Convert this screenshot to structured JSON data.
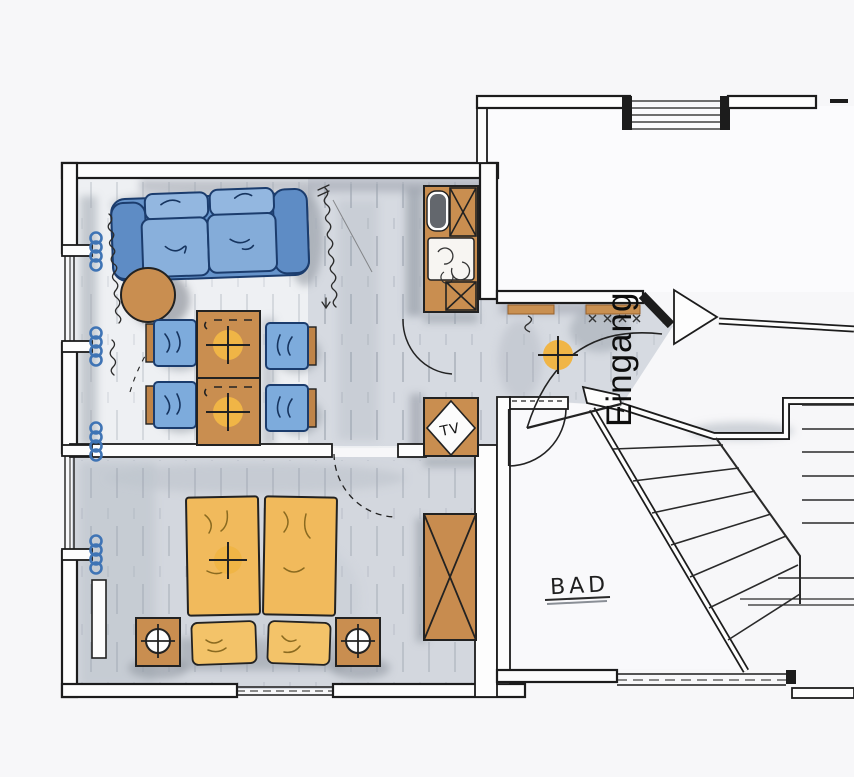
{
  "labels": {
    "tv": "TV",
    "entrance": "Eingang",
    "bathroom": "BAD"
  },
  "colors": {
    "wall_line": "#1c1c1c",
    "paper": "#f7f7f9",
    "floor_gray": "#d3d7de",
    "sofa_blue": "#6694cb",
    "cushion_blue": "#89b0dc",
    "chair_blue": "#7dabdc",
    "wood_brown": "#c98e50",
    "bed_orange": "#f1ba5c",
    "pillow_orange": "#f3c369",
    "lamp_yellow": "#f0b546",
    "radiator_blue": "#3f74b5",
    "shadow_gray": "#9aa1ab",
    "sink_gray": "#63676d"
  },
  "plan": {
    "type": "hand-drawn apartment floor plan",
    "labeled_rooms": [
      "BAD",
      "Eingang"
    ],
    "depicted_elements": [
      "sofa",
      "round-side-table",
      "dining-tables",
      "four-chairs",
      "kitchenette-sink-stove-cabinets",
      "tv-corner-cabinet",
      "double-beds",
      "pillows",
      "nightstands-with-lamps",
      "wardrobe",
      "radiator-coils",
      "windows",
      "entrance-door",
      "bathroom-door",
      "staircase",
      "ceiling-lamps",
      "doormats"
    ]
  }
}
